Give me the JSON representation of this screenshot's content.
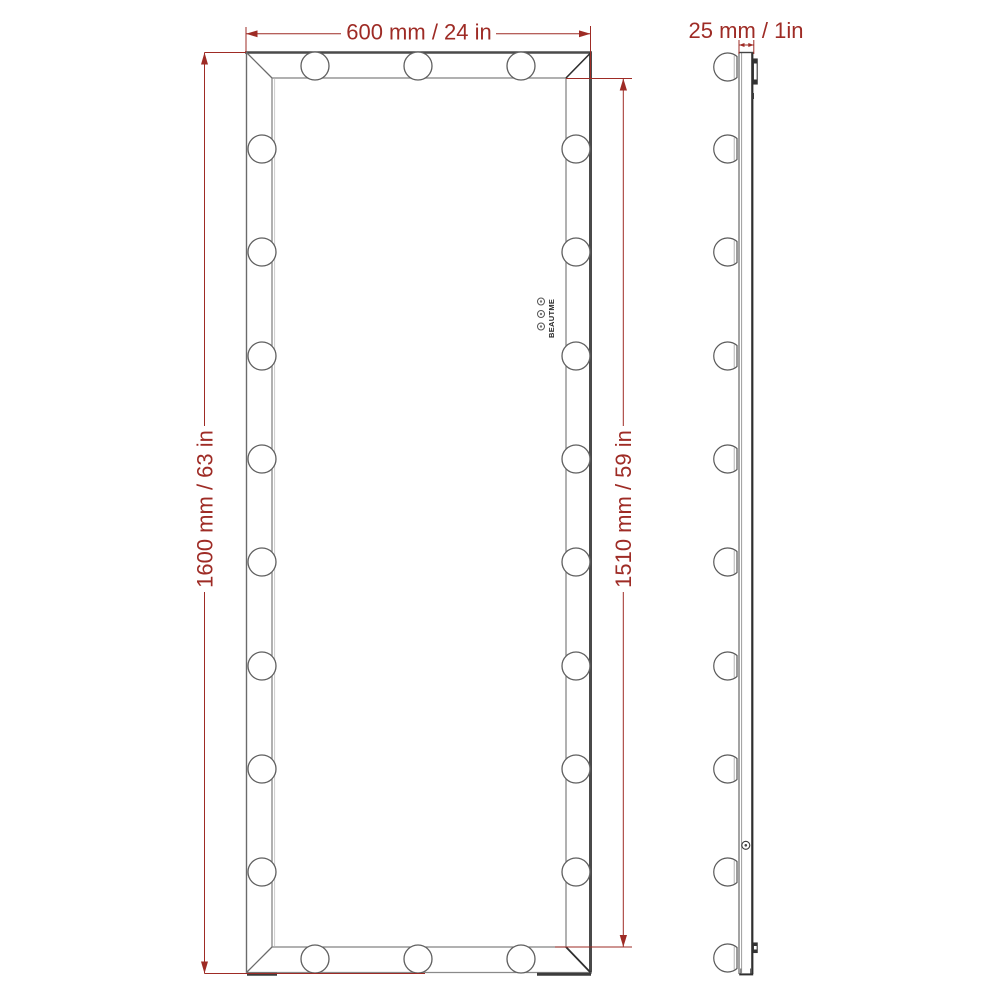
{
  "figure": {
    "type": "technical-dimension-diagram",
    "subject": "Hollywood vanity mirror with light bulbs, front view and side profile view",
    "front_view_bulb_count": 22,
    "side_view_bulb_count": 10
  },
  "dimensions": {
    "width": "600 mm / 24 in",
    "depth": "25 mm / 1in",
    "height": "1600 mm / 63 in",
    "inner_height": "1510 mm / 59 in"
  },
  "brand": {
    "name": "BEAUTME"
  },
  "colors": {
    "dimension_red": "#9e2b25",
    "line_gray": "#6b6b6b",
    "dark_edge": "#3c3c3c",
    "background": "#ffffff"
  }
}
